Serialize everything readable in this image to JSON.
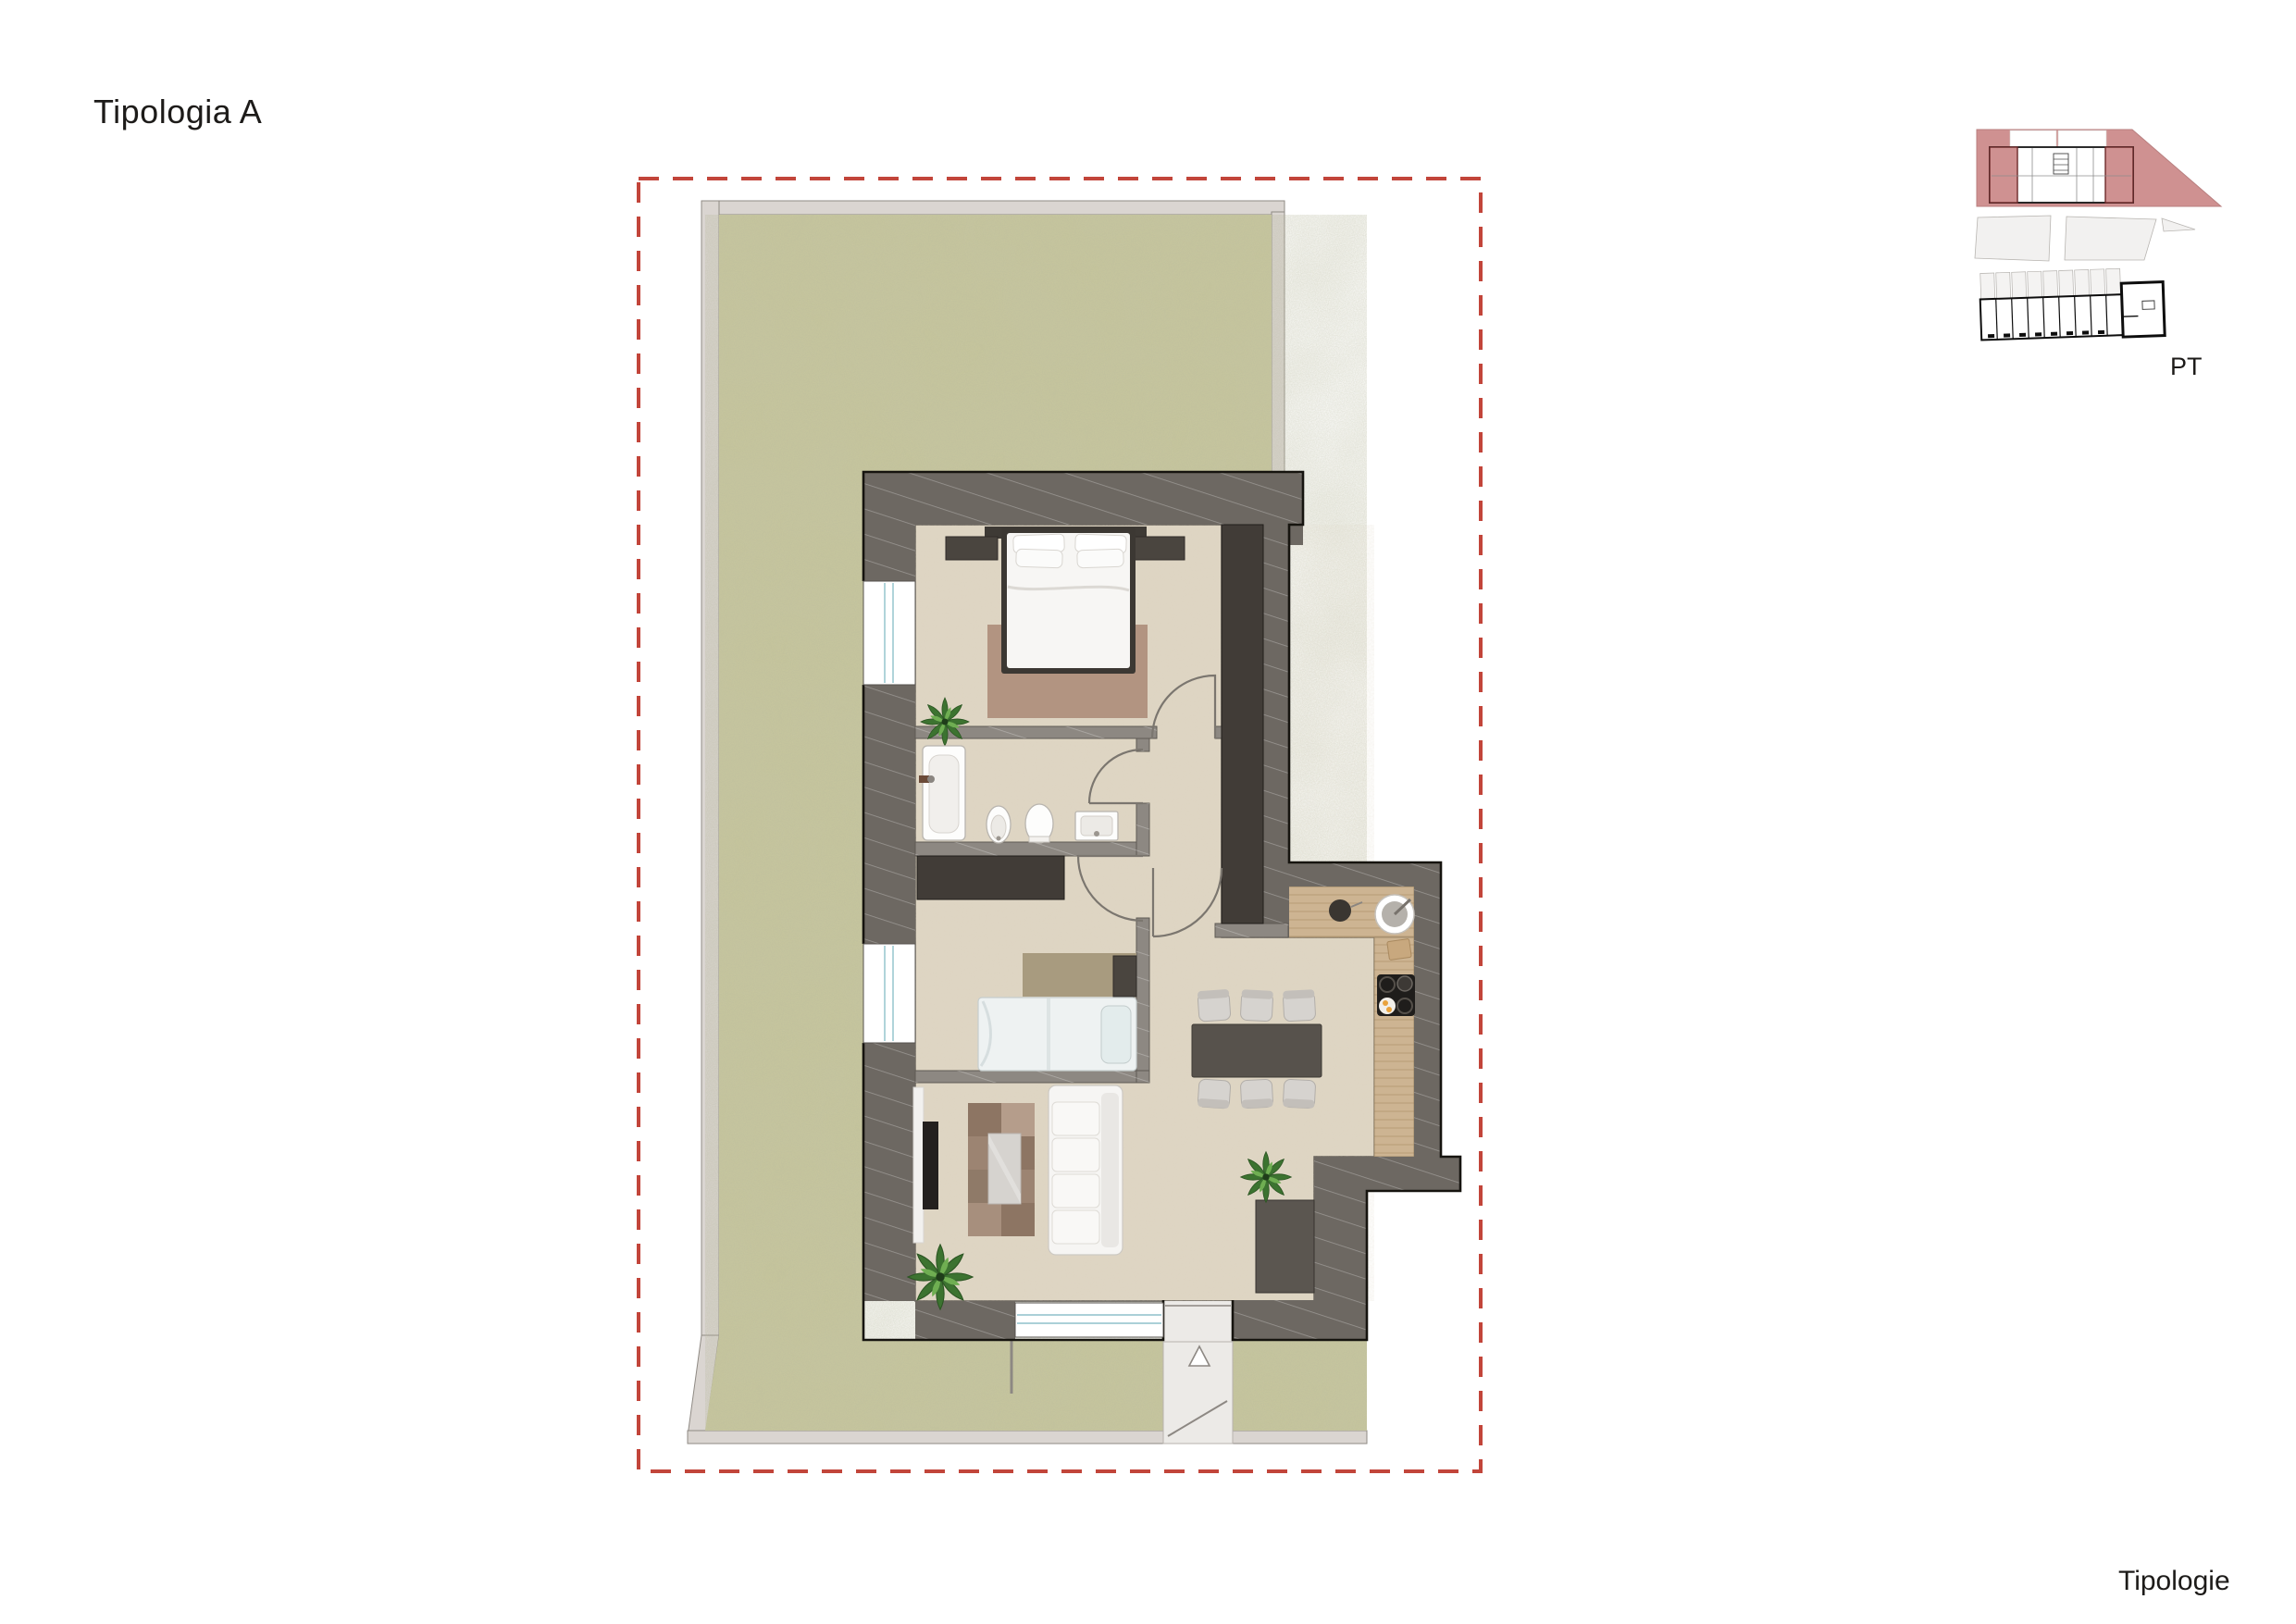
{
  "title": "Tipologia A",
  "footer": "Tipologie",
  "locator": {
    "floor_label": "PT",
    "description": "key-plan with highlighted end units and row building"
  },
  "colors": {
    "boundary": "#c2453a",
    "grass": "#c8c79d",
    "garden-border": "#dad5d1",
    "wall-outer": "#6d6862",
    "wall-inner": "#8d8882",
    "floor": "#ded5c3",
    "wood": "#cdb492",
    "dark": "#413c37",
    "pink": "#cf9191",
    "ink": "#1d1b19",
    "rug1": "#b29481",
    "rug2": "#9c8472",
    "rug3": "#a89b7f",
    "white-furn": "#f6f5f3",
    "table": "#57524c",
    "path": "#eceae7",
    "arc": "#7b766f",
    "win-blue": "#8fc1cb"
  },
  "plan": {
    "boundary": "red dashed property line",
    "rooms": [
      "garden",
      "double-bedroom",
      "bathroom",
      "single-bedroom",
      "hallway",
      "living-room",
      "dining-area",
      "kitchen",
      "entry-porch"
    ],
    "furniture": [
      "double-bed",
      "nightstands",
      "bedroom-rug",
      "plant",
      "bathtub",
      "bidet",
      "toilet",
      "washbasin",
      "wardrobe",
      "single-bed",
      "tv",
      "sofa",
      "coffee-table",
      "living-rug",
      "dining-table",
      "six-chairs",
      "kitchen-counter",
      "round-sink",
      "cooktop",
      "entry-arrow"
    ]
  }
}
